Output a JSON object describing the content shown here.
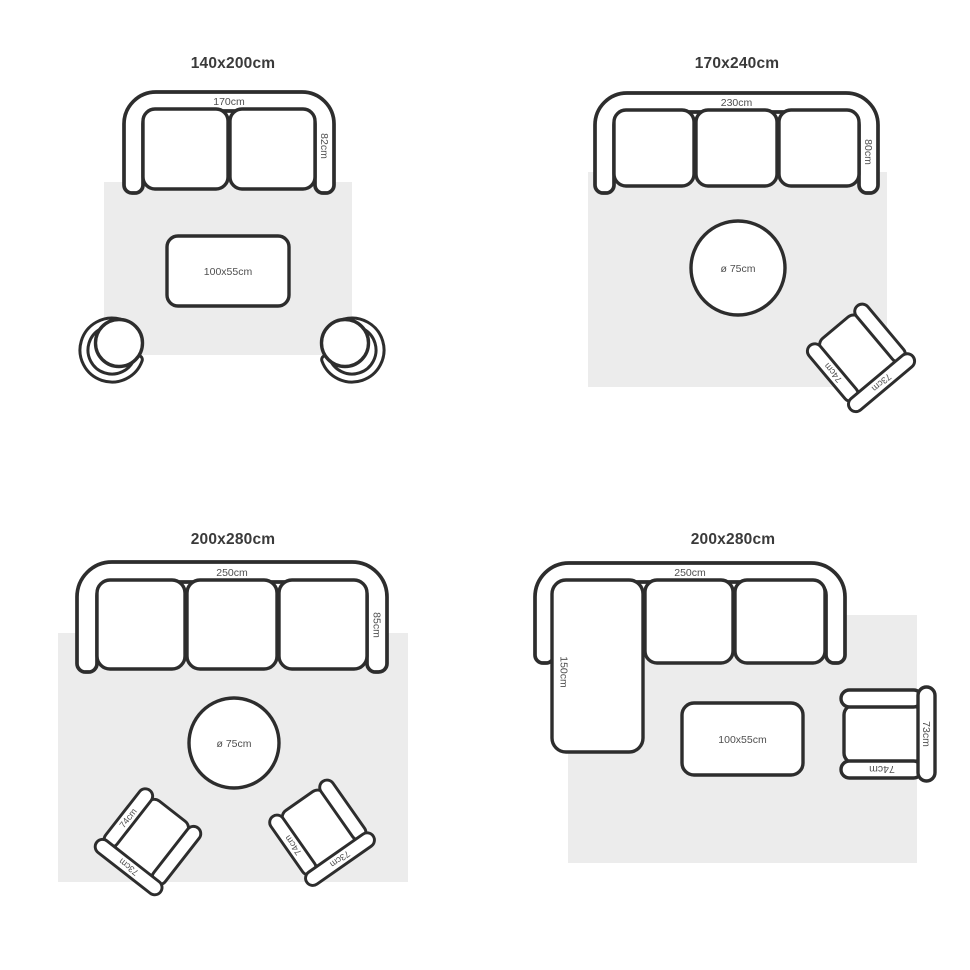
{
  "colors": {
    "outline": "#2d2d2d",
    "rug": "#ececec",
    "title_text": "#3a3a3a",
    "label_text": "#4f4f4f"
  },
  "layouts": {
    "top_left": {
      "title": "140x200cm",
      "sofa_width": "170cm",
      "sofa_depth": "82cm",
      "coffee_table": "100x55cm"
    },
    "top_right": {
      "title": "170x240cm",
      "sofa_width": "230cm",
      "sofa_depth": "80cm",
      "round_table": "ø 75cm",
      "armchair": {
        "arm": "74cm",
        "back": "73cm"
      }
    },
    "bottom_left": {
      "title": "200x280cm",
      "sofa_width": "250cm",
      "sofa_depth": "85cm",
      "round_table": "ø 75cm",
      "armchair_left": {
        "arm": "74cm",
        "back": "73cm"
      },
      "armchair_right": {
        "arm": "74cm",
        "back": "73cm"
      }
    },
    "bottom_right": {
      "title": "200x280cm",
      "sofa_width": "250cm",
      "chaise_depth": "150cm",
      "coffee_table": "100x55cm",
      "armchair": {
        "arm": "74cm",
        "back": "73cm"
      }
    }
  }
}
